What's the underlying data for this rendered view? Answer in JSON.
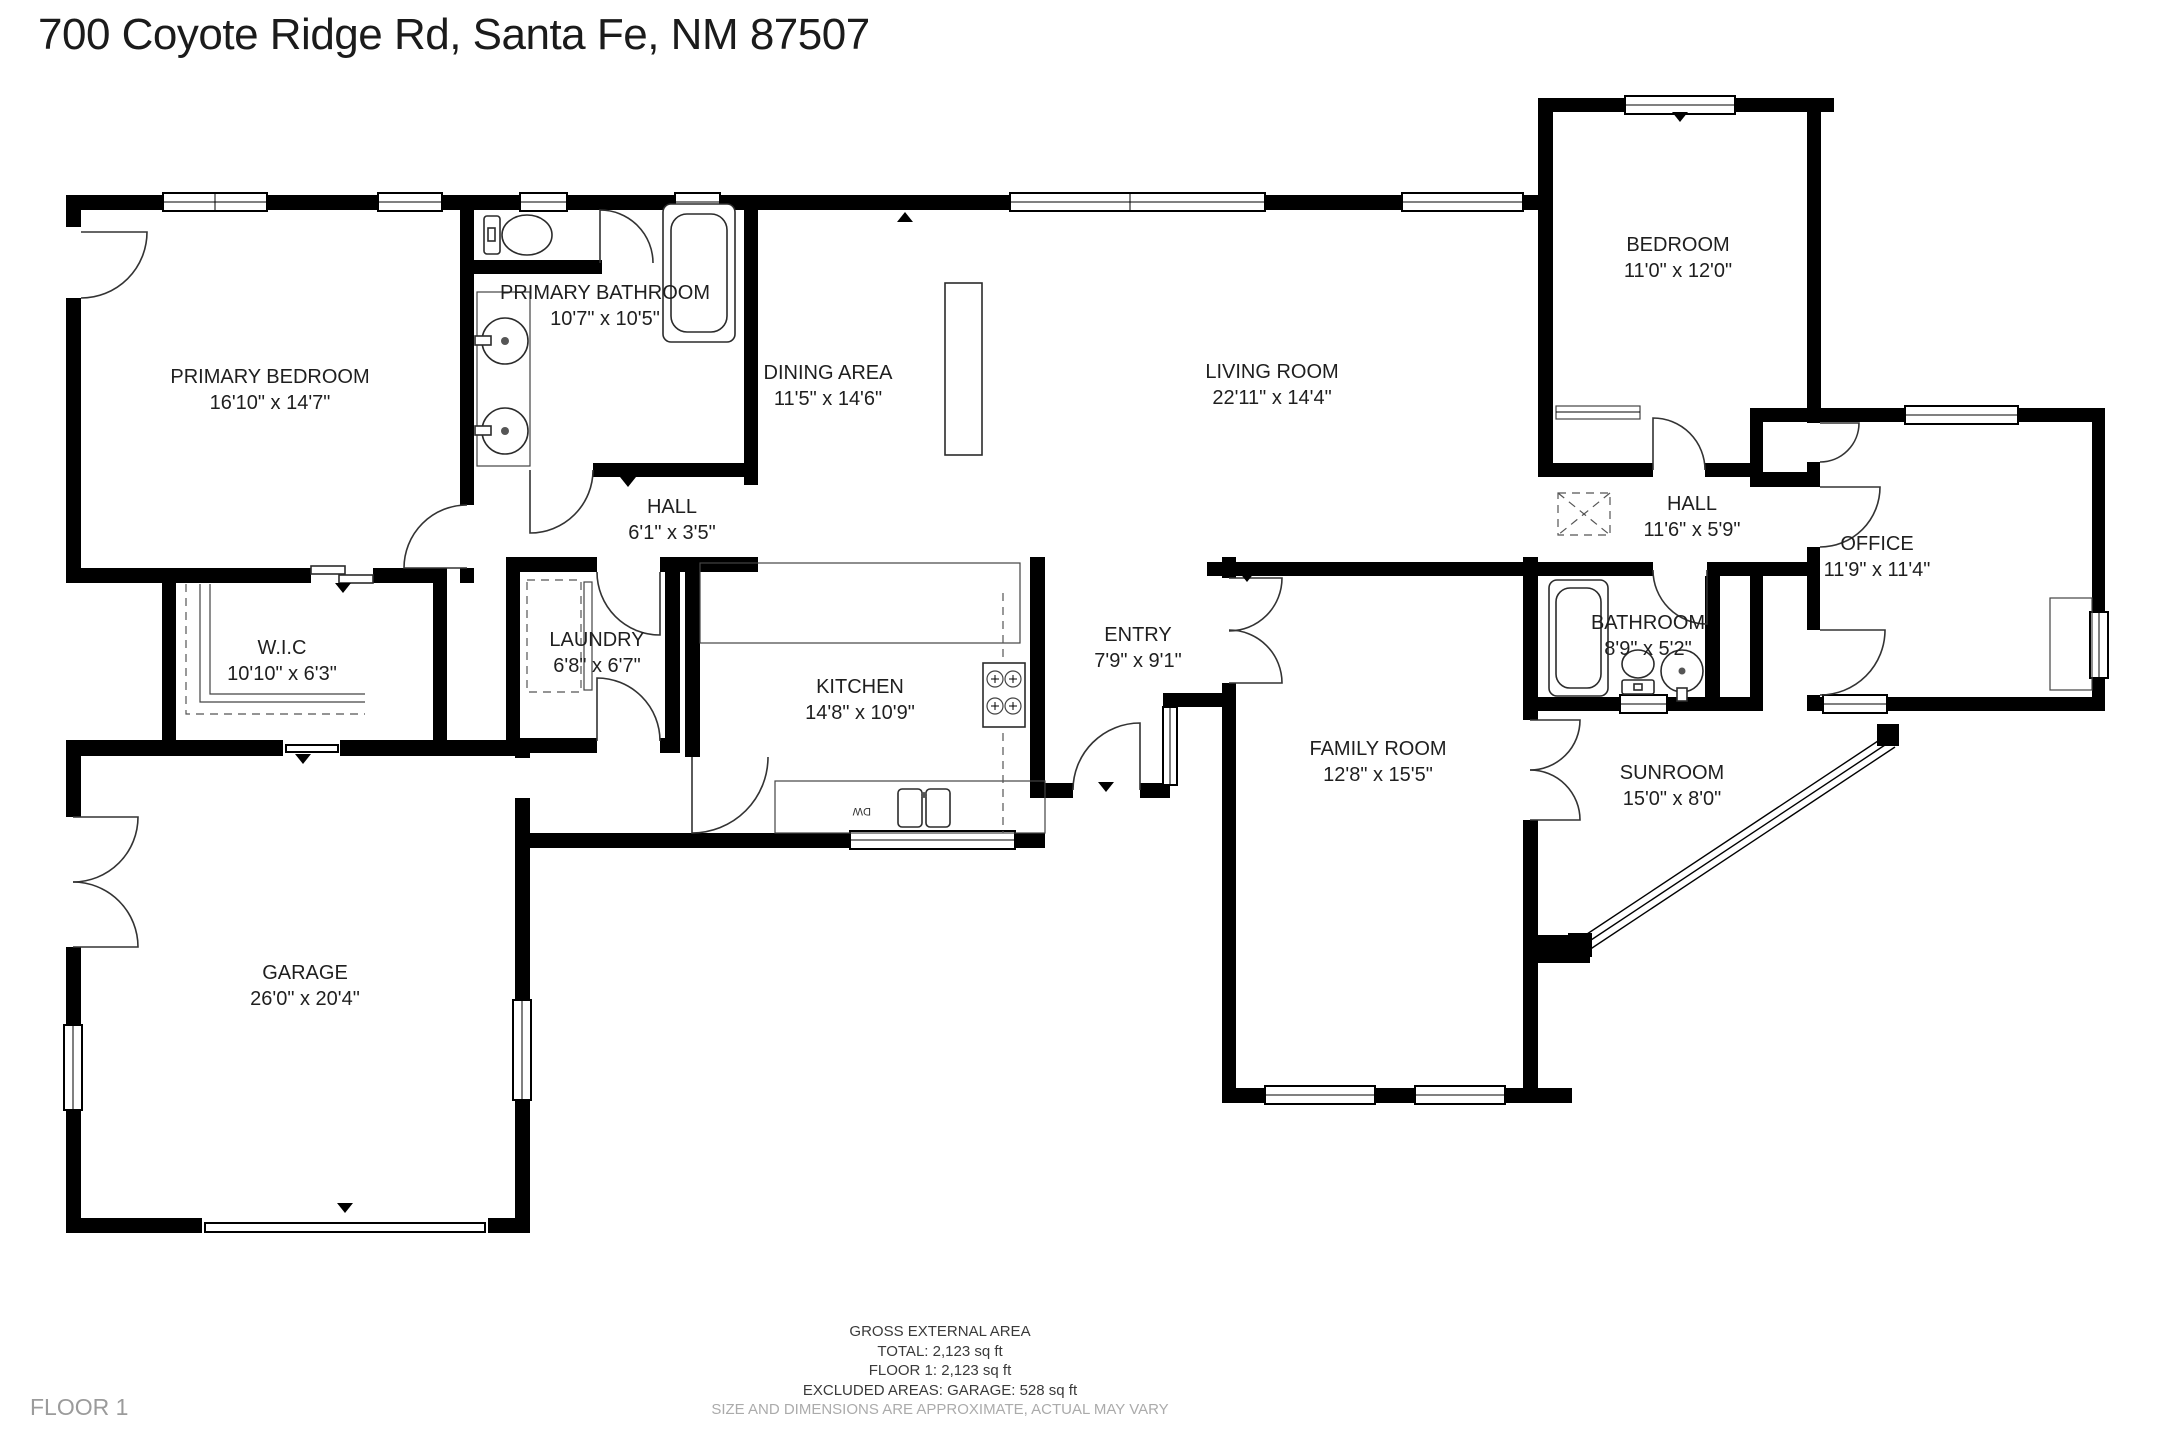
{
  "title": "700 Coyote Ridge Rd, Santa Fe, NM 87507",
  "floor_label": "FLOOR 1",
  "rooms": [
    {
      "id": "primary-bedroom",
      "name": "PRIMARY BEDROOM",
      "dims": "16'10\" x 14'7\""
    },
    {
      "id": "primary-bathroom",
      "name": "PRIMARY BATHROOM",
      "dims": "10'7\" x 10'5\""
    },
    {
      "id": "dining-area",
      "name": "DINING AREA",
      "dims": "11'5\" x 14'6\""
    },
    {
      "id": "living-room",
      "name": "LIVING ROOM",
      "dims": "22'11\" x 14'4\""
    },
    {
      "id": "bedroom",
      "name": "BEDROOM",
      "dims": "11'0\" x 12'0\""
    },
    {
      "id": "hall-upper-right",
      "name": "HALL",
      "dims": "11'6\" x 5'9\""
    },
    {
      "id": "office",
      "name": "OFFICE",
      "dims": "11'9\" x 11'4\""
    },
    {
      "id": "hall-left",
      "name": "HALL",
      "dims": "6'1\" x 3'5\""
    },
    {
      "id": "walk-in-closet",
      "name": "W.I.C",
      "dims": "10'10\" x 6'3\""
    },
    {
      "id": "laundry",
      "name": "LAUNDRY",
      "dims": "6'8\" x 6'7\""
    },
    {
      "id": "kitchen",
      "name": "KITCHEN",
      "dims": "14'8\" x 10'9\""
    },
    {
      "id": "entry",
      "name": "ENTRY",
      "dims": "7'9\" x 9'1\""
    },
    {
      "id": "family-room",
      "name": "FAMILY ROOM",
      "dims": "12'8\" x 15'5\""
    },
    {
      "id": "bathroom",
      "name": "BATHROOM",
      "dims": "8'9\" x 5'2\""
    },
    {
      "id": "sunroom",
      "name": "SUNROOM",
      "dims": "15'0\" x 8'0\""
    },
    {
      "id": "garage",
      "name": "GARAGE",
      "dims": "26'0\" x 20'4\""
    }
  ],
  "kitchen_labels": {
    "dishwasher": "DW"
  },
  "footer": {
    "area_title": "GROSS EXTERNAL AREA",
    "total": "TOTAL: 2,123 sq ft",
    "floor1": "FLOOR 1: 2,123 sq ft",
    "excluded": "EXCLUDED AREAS: GARAGE: 528 sq ft",
    "disclaimer": "SIZE AND DIMENSIONS ARE APPROXIMATE, ACTUAL MAY VARY"
  },
  "colors": {
    "wall": "#000000",
    "label_text": "#1f1f1f",
    "muted_text": "#ababab"
  }
}
